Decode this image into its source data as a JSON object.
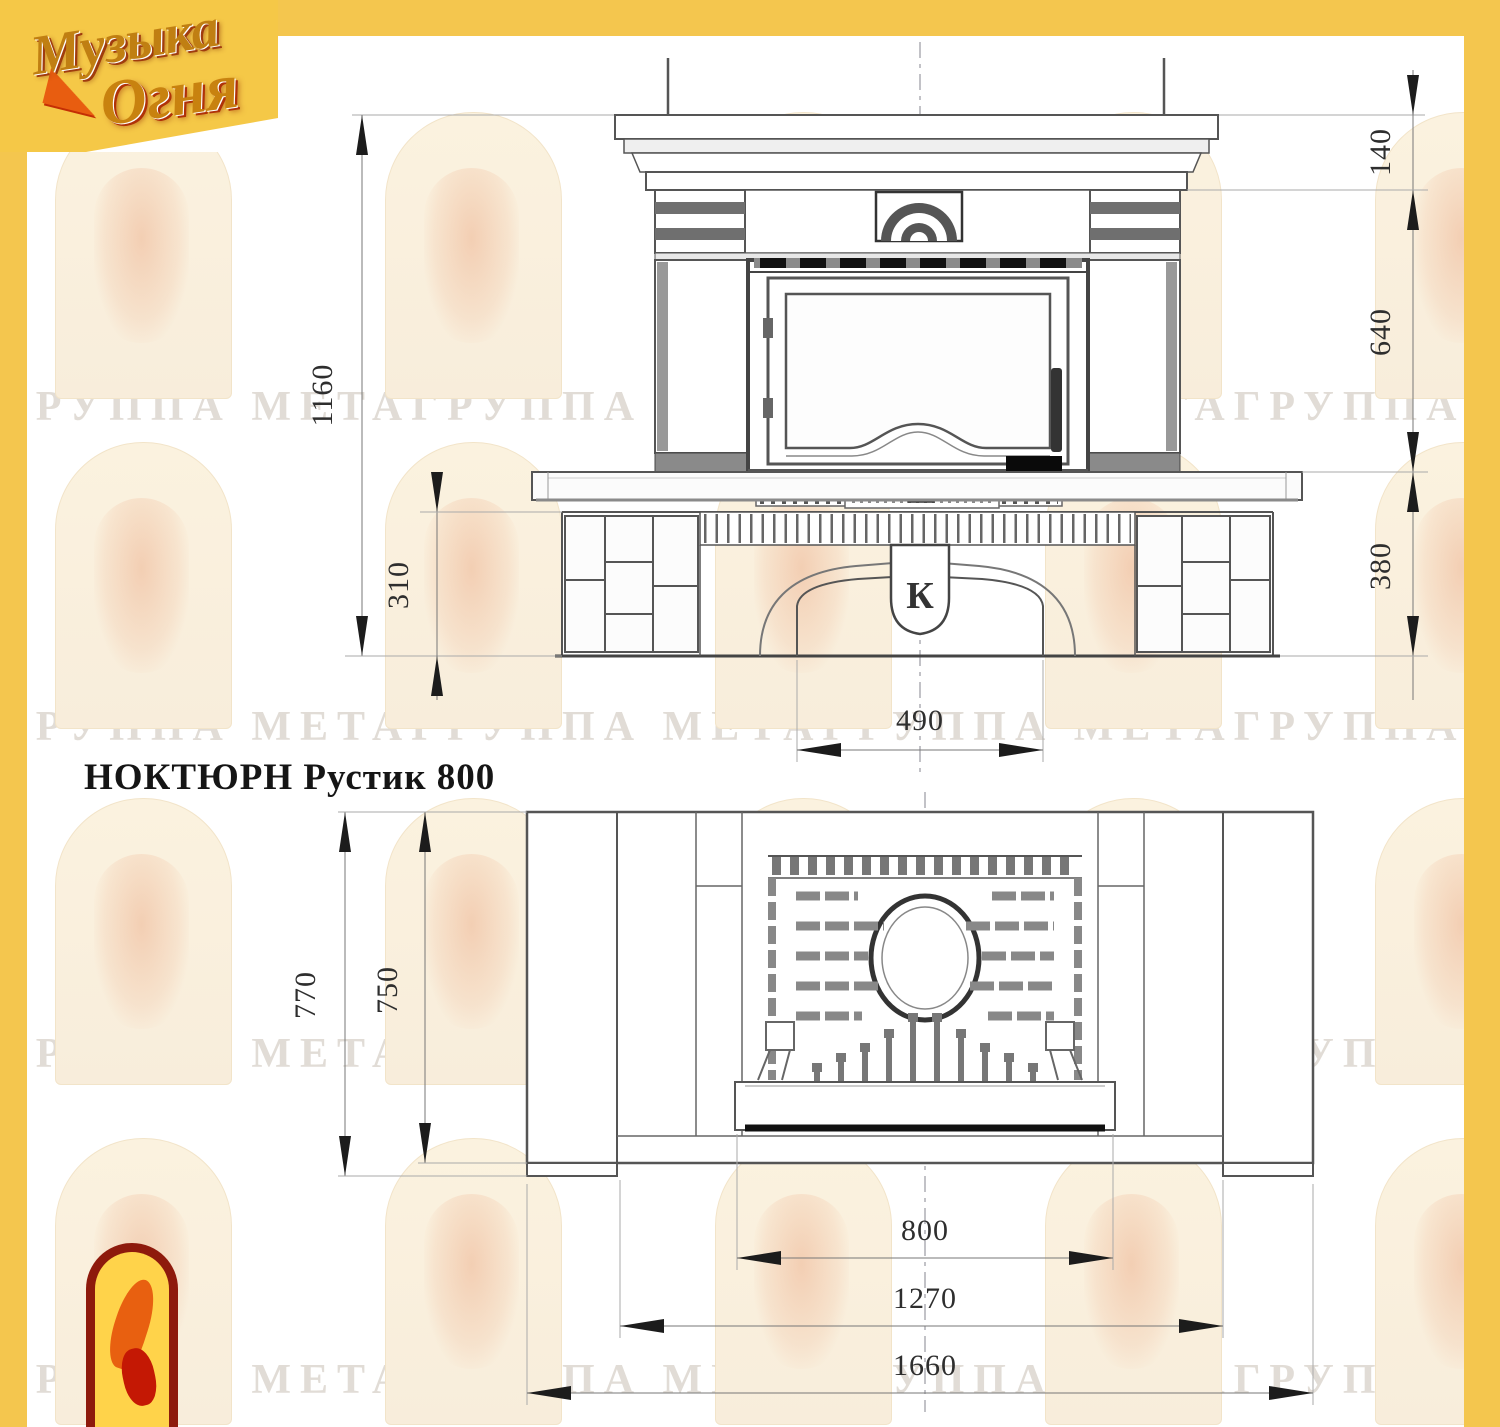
{
  "title": "НОКТЮРН Рустик 800",
  "logo": {
    "line1": "Музыка",
    "line2": "Огня"
  },
  "front_view": {
    "dims": {
      "total_height": "1160",
      "plinth_height": "310",
      "cornice_height": "140",
      "middle_height": "640",
      "firebox_floor_height": "380",
      "opening_width": "490"
    },
    "keystone_letter": "К"
  },
  "plan_view": {
    "dims": {
      "total_depth": "770",
      "body_depth": "750",
      "insert_width": "800",
      "front_width": "1270",
      "total_width": "1660"
    }
  },
  "watermark": {
    "row_text": "ГРУППА МЕТАГРУППА МЕТАГРУППА МЕТАГРУППА МЕТАГРУППА МЕТА"
  },
  "colors": {
    "frame_yellow": "#f4c64e",
    "line": "#555555",
    "dim_text": "#2e2e2e"
  }
}
